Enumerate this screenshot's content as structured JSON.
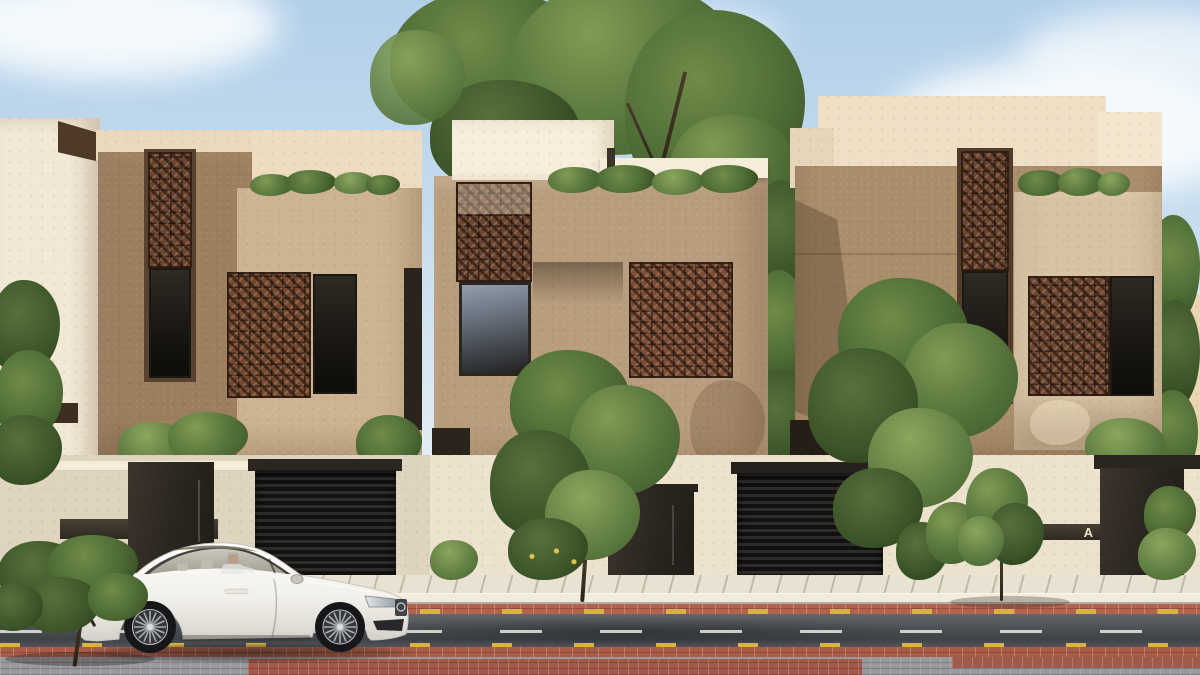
{
  "scene": {
    "description": "Street-level architectural rendering of three modern Najdi-style villas with brown mashrabiya screens, a cream compound wall, landscaped sidewalk and a white luxury coupe parked on the road",
    "setting": "daytime, clear blue sky with soft clouds"
  },
  "villas": [
    {
      "name": "left-villa",
      "unit_label": "A",
      "facade_color": "#9d7f5f",
      "accent_color": "#ccb492",
      "screen_color": "#6b4530"
    },
    {
      "name": "middle-villa",
      "unit_label": "B",
      "facade_color": "#b89d7d",
      "screen_color": "#7c4e37"
    },
    {
      "name": "right-villa",
      "unit_label": "A",
      "facade_color": "#aa8e6c",
      "screen_color": "#6f4833"
    }
  ],
  "compound_wall": {
    "color": "#ece2cd",
    "signage_band_color": "#3a3229",
    "label_color": "#eadfc6",
    "door_color": "#332d25",
    "garage_color": "#1f1d1a"
  },
  "street": {
    "sidewalk_color": "#e8e2d2",
    "brick_color": "#b2634d",
    "asphalt_color": "#53565a",
    "lane_marking_color": "#e9e7df",
    "edge_dash_color": "#d7b346",
    "paver_color": "#97999d",
    "paver_red_color": "#a2584a"
  },
  "car": {
    "type": "white coupe",
    "body_color": "#f2f0ea",
    "wheel_color": "#2e3033",
    "occupant": "driver in white shirt"
  },
  "sky": {
    "top_color": "#b5d1e9",
    "horizon_color": "#e3edf4",
    "cloud_color": "#f4f8fb"
  },
  "vegetation": {
    "canopy_colors": [
      "#32491f",
      "#4e6b35",
      "#6f8c49",
      "#87a55e"
    ]
  }
}
